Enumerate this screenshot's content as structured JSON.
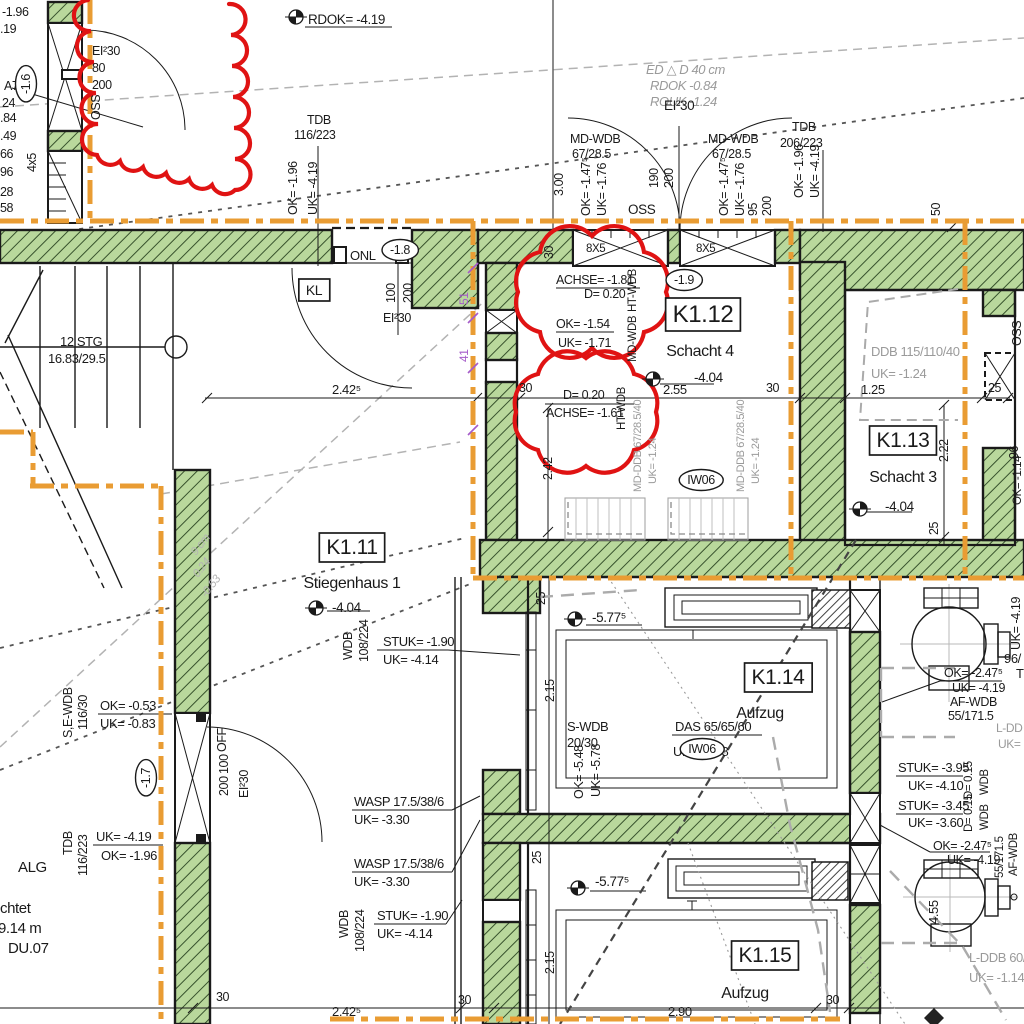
{
  "canvas": {
    "width": 1024,
    "height": 1024,
    "kind": "architectural-floor-plan"
  },
  "colors": {
    "ink": "#1a1a1a",
    "gray": "#9a9a9a",
    "lightgray": "#b4b4b4",
    "orange": "#e99c33",
    "red": "#e01313",
    "purple": "#a55bc9",
    "wall_green": "#b9d89c",
    "hatch_green": "#37522c"
  },
  "rooms": [
    {
      "tag": "K1.11",
      "name": "Stiegenhaus 1",
      "level": "-4.04"
    },
    {
      "tag": "K1.12",
      "name": "Schacht 4",
      "level": "-4.04"
    },
    {
      "tag": "K1.13",
      "name": "Schacht 3",
      "level": "-4.04"
    },
    {
      "tag": "K1.14",
      "name": "Aufzug",
      "level": "-5.77⁵"
    },
    {
      "tag": "K1.15",
      "name": "Aufzug",
      "level": "-5.77⁵"
    }
  ],
  "labels": [
    {
      "t": "-1.96",
      "x": 2,
      "y": 16
    },
    {
      "t": ".19",
      "x": 0,
      "y": 33
    },
    {
      "t": "A7",
      "x": 4,
      "y": 90
    },
    {
      "t": "-1.6",
      "x": 30,
      "y": 84,
      "r": -90,
      "oval": 1,
      "a": "m",
      "n": "level-bubble"
    },
    {
      "t": "24",
      "x": 2,
      "y": 107
    },
    {
      "t": ".84",
      "x": 0,
      "y": 122
    },
    {
      "t": ".49",
      "x": 0,
      "y": 140
    },
    {
      "t": "66",
      "x": 0,
      "y": 158
    },
    {
      "t": "96",
      "x": 0,
      "y": 176
    },
    {
      "t": "28",
      "x": 0,
      "y": 196
    },
    {
      "t": "58",
      "x": 0,
      "y": 212
    },
    {
      "t": "4x5",
      "x": 36,
      "y": 172,
      "r": -90
    },
    {
      "t": "EI²30",
      "x": 92,
      "y": 55
    },
    {
      "t": "80",
      "x": 92,
      "y": 72
    },
    {
      "t": "200",
      "x": 92,
      "y": 89
    },
    {
      "t": "OSS",
      "x": 100,
      "y": 120,
      "r": -90
    },
    {
      "t": "RDOK= -4.19",
      "x": 308,
      "y": 24,
      "s": 13.5,
      "n": "level-annotation"
    },
    {
      "t": "TDB",
      "x": 307,
      "y": 124
    },
    {
      "t": "116/223",
      "x": 294,
      "y": 139
    },
    {
      "t": "OK= -1.96",
      "x": 297,
      "y": 215,
      "r": -90
    },
    {
      "t": "UK= -4.19",
      "x": 317,
      "y": 215,
      "r": -90
    },
    {
      "t": "3.00",
      "x": 563,
      "y": 196,
      "r": -90
    },
    {
      "t": "ED  △ D 40 cm",
      "x": 646,
      "y": 74,
      "c": "gray",
      "i": 1,
      "s": 13
    },
    {
      "t": "RDOK -0.84",
      "x": 650,
      "y": 90,
      "c": "gray",
      "i": 1,
      "s": 13
    },
    {
      "t": "ROUK -1.24",
      "x": 650,
      "y": 106,
      "c": "gray",
      "i": 1,
      "s": 13
    },
    {
      "t": "MD-WDB",
      "x": 570,
      "y": 143
    },
    {
      "t": "67/28.5",
      "x": 572,
      "y": 158
    },
    {
      "t": "OK= -1.47⁵",
      "x": 590,
      "y": 216,
      "r": -90
    },
    {
      "t": "UK= -1.76",
      "x": 606,
      "y": 216,
      "r": -90
    },
    {
      "t": "EI²30",
      "x": 664,
      "y": 110,
      "s": 13.5
    },
    {
      "t": "190",
      "x": 658,
      "y": 188,
      "r": -90
    },
    {
      "t": "200",
      "x": 673,
      "y": 188,
      "r": -90
    },
    {
      "t": "OSS",
      "x": 628,
      "y": 214,
      "s": 13.5
    },
    {
      "t": "MD-WDB",
      "x": 708,
      "y": 143
    },
    {
      "t": "67/28.5",
      "x": 712,
      "y": 158
    },
    {
      "t": "OK= -1.47⁵",
      "x": 728,
      "y": 216,
      "r": -90
    },
    {
      "t": "UK= -1.76",
      "x": 744,
      "y": 216,
      "r": -90
    },
    {
      "t": "95",
      "x": 757,
      "y": 216,
      "r": -90
    },
    {
      "t": "200",
      "x": 771,
      "y": 216,
      "r": -90
    },
    {
      "t": "TDB",
      "x": 792,
      "y": 131
    },
    {
      "t": "206/223",
      "x": 780,
      "y": 147
    },
    {
      "t": "OK= -1.96",
      "x": 803,
      "y": 198,
      "r": -90
    },
    {
      "t": "UK= -4.19",
      "x": 819,
      "y": 198,
      "r": -90
    },
    {
      "t": "50",
      "x": 940,
      "y": 216,
      "r": -90
    },
    {
      "t": "ONL",
      "x": 350,
      "y": 260,
      "s": 13
    },
    {
      "t": "-1.8",
      "x": 400,
      "y": 254,
      "oval": 1,
      "a": "m",
      "n": "level-bubble"
    },
    {
      "t": "100",
      "x": 395,
      "y": 303,
      "r": -90
    },
    {
      "t": "200",
      "x": 412,
      "y": 303,
      "r": -90
    },
    {
      "t": "EI²30",
      "x": 383,
      "y": 322
    },
    {
      "t": "KL",
      "x": 314,
      "y": 295,
      "box": 1,
      "a": "m",
      "s": 14
    },
    {
      "t": "12 STG",
      "x": 60,
      "y": 346,
      "s": 13
    },
    {
      "t": "16.83/29.5",
      "x": 48,
      "y": 363,
      "s": 13
    },
    {
      "t": "2.42⁵",
      "x": 332,
      "y": 394,
      "s": 13
    },
    {
      "t": "30",
      "x": 519,
      "y": 392
    },
    {
      "t": "2.55",
      "x": 663,
      "y": 394,
      "s": 13
    },
    {
      "t": "30",
      "x": 766,
      "y": 392
    },
    {
      "t": "1.25",
      "x": 861,
      "y": 394,
      "s": 13
    },
    {
      "t": "25",
      "x": 988,
      "y": 392
    },
    {
      "t": "30",
      "x": 553,
      "y": 259,
      "r": -90
    },
    {
      "t": "2.42",
      "x": 552,
      "y": 480,
      "r": -90
    },
    {
      "t": "2.22",
      "x": 948,
      "y": 462,
      "r": -90
    },
    {
      "t": "25",
      "x": 938,
      "y": 535,
      "r": -90
    },
    {
      "t": "ACHSE= -1.81",
      "x": 556,
      "y": 284
    },
    {
      "t": "D= 0.20",
      "x": 584,
      "y": 298
    },
    {
      "t": "OK= -1.54",
      "x": 556,
      "y": 328
    },
    {
      "t": "UK= -1.71",
      "x": 558,
      "y": 347
    },
    {
      "t": "HT-WDB",
      "x": 636,
      "y": 312,
      "r": -90,
      "s": 11.5
    },
    {
      "t": "MD-WDB",
      "x": 636,
      "y": 362,
      "r": -90,
      "s": 11.5
    },
    {
      "t": "-1.9",
      "x": 684,
      "y": 284,
      "oval": 1,
      "a": "m",
      "n": "level-bubble"
    },
    {
      "t": "K1.12",
      "x": 703,
      "y": 322,
      "box": 1,
      "a": "m",
      "s": 24,
      "n": "room-tag-k1-12"
    },
    {
      "t": "Schacht 4",
      "x": 700,
      "y": 356,
      "s": 16,
      "a": "m",
      "n": "room-name"
    },
    {
      "t": "-4.04",
      "x": 694,
      "y": 382,
      "s": 13.5,
      "n": "room-level"
    },
    {
      "t": "8X5",
      "x": 586,
      "y": 252,
      "s": 11.5
    },
    {
      "t": "8X5",
      "x": 696,
      "y": 252,
      "s": 11.5
    },
    {
      "t": "D= 0.20",
      "x": 563,
      "y": 399
    },
    {
      "t": "ACHSE= -1.61",
      "x": 546,
      "y": 417
    },
    {
      "t": "HT-WDB",
      "x": 625,
      "y": 430,
      "r": -90,
      "s": 11.5
    },
    {
      "t": "MD-DDB 67/28.5/40",
      "x": 641,
      "y": 492,
      "r": -90,
      "s": 11,
      "c": "gray"
    },
    {
      "t": "UK= -1.24",
      "x": 656,
      "y": 484,
      "r": -90,
      "s": 11,
      "c": "gray"
    },
    {
      "t": "MD-DDB 67/28.5/40",
      "x": 744,
      "y": 492,
      "r": -90,
      "s": 11,
      "c": "gray"
    },
    {
      "t": "UK= -1.24",
      "x": 759,
      "y": 484,
      "r": -90,
      "s": 11,
      "c": "gray"
    },
    {
      "t": "IW06",
      "x": 701,
      "y": 484,
      "oval": 1,
      "a": "m",
      "n": "wall-type-bubble"
    },
    {
      "t": "DDB  115/110/40",
      "x": 871,
      "y": 356,
      "c": "gray",
      "s": 13
    },
    {
      "t": "UK= -1.24",
      "x": 871,
      "y": 378,
      "c": "gray",
      "s": 13
    },
    {
      "t": "K1.13",
      "x": 903,
      "y": 447,
      "box": 1,
      "a": "m",
      "s": 21,
      "n": "room-tag-k1-13"
    },
    {
      "t": "Schacht 3",
      "x": 903,
      "y": 482,
      "s": 16,
      "a": "m",
      "n": "room-name"
    },
    {
      "t": "-4.04",
      "x": 885,
      "y": 511,
      "s": 13.5,
      "n": "room-level"
    },
    {
      "t": "K1.11",
      "x": 352,
      "y": 554,
      "box": 1,
      "a": "m",
      "s": 21,
      "n": "room-tag-k1-11"
    },
    {
      "t": "Stiegenhaus 1",
      "x": 352,
      "y": 588,
      "s": 16,
      "a": "m",
      "n": "room-name"
    },
    {
      "t": "-4.04",
      "x": 332,
      "y": 612,
      "s": 13.5,
      "n": "room-level"
    },
    {
      "t": "9 cm",
      "x": 196,
      "y": 556,
      "r": -52,
      "c": "lightgray",
      "i": 1,
      "s": 11.5
    },
    {
      "t": "0.24",
      "x": 198,
      "y": 578,
      "r": -52,
      "c": "lightgray",
      "i": 1,
      "s": 11.5
    },
    {
      "t": "-0.53",
      "x": 206,
      "y": 598,
      "r": -52,
      "c": "lightgray",
      "i": 1,
      "s": 11.5
    },
    {
      "t": "WDB",
      "x": 352,
      "y": 660,
      "r": -90
    },
    {
      "t": "108/224",
      "x": 368,
      "y": 662,
      "r": -90
    },
    {
      "t": "STUK= -1.90",
      "x": 383,
      "y": 646,
      "s": 13
    },
    {
      "t": "UK= -4.14",
      "x": 383,
      "y": 664,
      "s": 13
    },
    {
      "t": "S,E-WDB",
      "x": 72,
      "y": 738,
      "r": -90
    },
    {
      "t": "116/30",
      "x": 87,
      "y": 730,
      "r": -90
    },
    {
      "t": "OK= -0.53",
      "x": 100,
      "y": 710,
      "s": 13
    },
    {
      "t": "UK= -0.83",
      "x": 100,
      "y": 728,
      "s": 13
    },
    {
      "t": "-1.7",
      "x": 150,
      "y": 778,
      "r": -90,
      "oval": 1,
      "a": "m",
      "n": "level-bubble"
    },
    {
      "t": "OFF",
      "x": 226,
      "y": 752,
      "r": -90
    },
    {
      "t": "100",
      "x": 228,
      "y": 774,
      "r": -90
    },
    {
      "t": "200",
      "x": 228,
      "y": 796,
      "r": -90
    },
    {
      "t": "EI²30",
      "x": 248,
      "y": 798,
      "r": -90
    },
    {
      "t": "TDB",
      "x": 72,
      "y": 855,
      "r": -90
    },
    {
      "t": "116/223",
      "x": 87,
      "y": 876,
      "r": -90
    },
    {
      "t": "UK= -4.19",
      "x": 96,
      "y": 841,
      "s": 13
    },
    {
      "t": "OK= -1.96",
      "x": 101,
      "y": 860,
      "s": 13
    },
    {
      "t": "ALG",
      "x": 18,
      "y": 872,
      "s": 15
    },
    {
      "t": "chtet",
      "x": 0,
      "y": 913,
      "s": 15
    },
    {
      "t": "39.14 m",
      "x": -10,
      "y": 933,
      "s": 15
    },
    {
      "t": "DU.07",
      "x": 8,
      "y": 953,
      "s": 15
    },
    {
      "t": "30",
      "x": 216,
      "y": 1001
    },
    {
      "t": "WASP 17.5/38/6",
      "x": 354,
      "y": 806,
      "s": 13
    },
    {
      "t": "UK= -3.30",
      "x": 354,
      "y": 824,
      "s": 13
    },
    {
      "t": "WASP 17.5/38/6",
      "x": 354,
      "y": 868,
      "s": 13
    },
    {
      "t": "UK= -3.30",
      "x": 354,
      "y": 886,
      "s": 13
    },
    {
      "t": "WDB",
      "x": 348,
      "y": 938,
      "r": -90
    },
    {
      "t": "108/224",
      "x": 364,
      "y": 952,
      "r": -90
    },
    {
      "t": "STUK= -1.90",
      "x": 377,
      "y": 920,
      "s": 13
    },
    {
      "t": "UK= -4.14",
      "x": 377,
      "y": 938,
      "s": 13
    },
    {
      "t": "25",
      "x": 545,
      "y": 605,
      "r": -90
    },
    {
      "t": "2.15",
      "x": 554,
      "y": 702,
      "r": -90
    },
    {
      "t": "25",
      "x": 541,
      "y": 864,
      "r": -90
    },
    {
      "t": "2.15",
      "x": 554,
      "y": 974,
      "r": -90
    },
    {
      "t": "-5.77⁵",
      "x": 592,
      "y": 622,
      "s": 13.5
    },
    {
      "t": "-5.77⁵",
      "x": 595,
      "y": 886,
      "s": 13.5
    },
    {
      "t": "K1.14",
      "x": 778,
      "y": 684,
      "box": 1,
      "a": "m",
      "s": 21,
      "n": "room-tag-k1-14"
    },
    {
      "t": "Aufzug",
      "x": 760,
      "y": 718,
      "s": 16,
      "a": "m",
      "n": "room-name"
    },
    {
      "t": "DAS 65/65/60",
      "x": 675,
      "y": 731,
      "s": 13
    },
    {
      "t": "UK= -3.38",
      "x": 673,
      "y": 756,
      "s": 13
    },
    {
      "t": "IW06",
      "x": 702,
      "y": 753,
      "oval": 1,
      "a": "m",
      "n": "wall-type-bubble"
    },
    {
      "t": "S-WDB",
      "x": 567,
      "y": 731,
      "s": 13
    },
    {
      "t": "20/30",
      "x": 567,
      "y": 747,
      "s": 13
    },
    {
      "t": "OK= -5.48",
      "x": 583,
      "y": 799,
      "r": -90
    },
    {
      "t": "UK= -5.78",
      "x": 600,
      "y": 797,
      "r": -90
    },
    {
      "t": "K1.15",
      "x": 765,
      "y": 962,
      "box": 1,
      "a": "m",
      "s": 21,
      "n": "room-tag-k1-15"
    },
    {
      "t": "Aufzug",
      "x": 745,
      "y": 998,
      "s": 16,
      "a": "m",
      "n": "room-name"
    },
    {
      "t": "2.42⁵",
      "x": 332,
      "y": 1016,
      "s": 13
    },
    {
      "t": "30",
      "x": 458,
      "y": 1004
    },
    {
      "t": "2.90",
      "x": 668,
      "y": 1016,
      "s": 13
    },
    {
      "t": "30",
      "x": 826,
      "y": 1004
    },
    {
      "t": "OK= -2.47⁵",
      "x": 944,
      "y": 677,
      "s": 12.5
    },
    {
      "t": "UK= -4.19",
      "x": 952,
      "y": 692,
      "s": 12.5
    },
    {
      "t": "AF-WDB",
      "x": 950,
      "y": 706,
      "s": 12.5
    },
    {
      "t": "55/171.5",
      "x": 948,
      "y": 720,
      "s": 12.5
    },
    {
      "t": "STUK= -3.95",
      "x": 898,
      "y": 772,
      "s": 13
    },
    {
      "t": "UK= -4.10",
      "x": 908,
      "y": 790,
      "s": 13
    },
    {
      "t": "STUK= -3.45",
      "x": 898,
      "y": 810,
      "s": 13
    },
    {
      "t": "UK= -3.60",
      "x": 908,
      "y": 827,
      "s": 13
    },
    {
      "t": "D= 0.15",
      "x": 972,
      "y": 799,
      "r": -90,
      "s": 11.5
    },
    {
      "t": "WDB",
      "x": 988,
      "y": 795,
      "r": -90,
      "s": 11.5
    },
    {
      "t": "D= 0.15",
      "x": 972,
      "y": 832,
      "r": -90,
      "s": 11.5
    },
    {
      "t": "WDB",
      "x": 988,
      "y": 830,
      "r": -90,
      "s": 11.5
    },
    {
      "t": "OK= -2.47⁵",
      "x": 933,
      "y": 850,
      "s": 12.5
    },
    {
      "t": "UK= -4.19",
      "x": 947,
      "y": 864,
      "s": 12.5
    },
    {
      "t": "55/171.5",
      "x": 1003,
      "y": 878,
      "r": -90,
      "s": 11.5
    },
    {
      "t": "AF-WDB",
      "x": 1017,
      "y": 876,
      "r": -90,
      "s": 11.5
    },
    {
      "t": "UK= -4.19",
      "x": 1020,
      "y": 650,
      "r": -90
    },
    {
      "t": "96/",
      "x": 1004,
      "y": 663,
      "s": 13
    },
    {
      "t": "TD",
      "x": 1016,
      "y": 678,
      "s": 13
    },
    {
      "t": "OSS",
      "x": 1021,
      "y": 346,
      "r": -90
    },
    {
      "t": "96",
      "x": 1018,
      "y": 459,
      "r": -90
    },
    {
      "t": "OK= -1.14",
      "x": 1021,
      "y": 505,
      "r": -90,
      "s": 11.5
    },
    {
      "t": "L-DDB 60/",
      "x": 969,
      "y": 962,
      "c": "gray",
      "s": 13
    },
    {
      "t": "UK= -1.14",
      "x": 969,
      "y": 982,
      "c": "gray",
      "s": 13
    },
    {
      "t": "L-DD",
      "x": 996,
      "y": 732,
      "c": "gray",
      "s": 12
    },
    {
      "t": "UK=",
      "x": 998,
      "y": 748,
      "c": "gray",
      "s": 12
    },
    {
      "t": "4.55",
      "x": 938,
      "y": 924,
      "r": -90,
      "s": 13
    },
    {
      "t": "51",
      "x": 468,
      "y": 305,
      "r": -90,
      "c": "purple",
      "s": 12
    },
    {
      "t": "41",
      "x": 468,
      "y": 362,
      "r": -90,
      "c": "purple",
      "s": 12
    }
  ]
}
